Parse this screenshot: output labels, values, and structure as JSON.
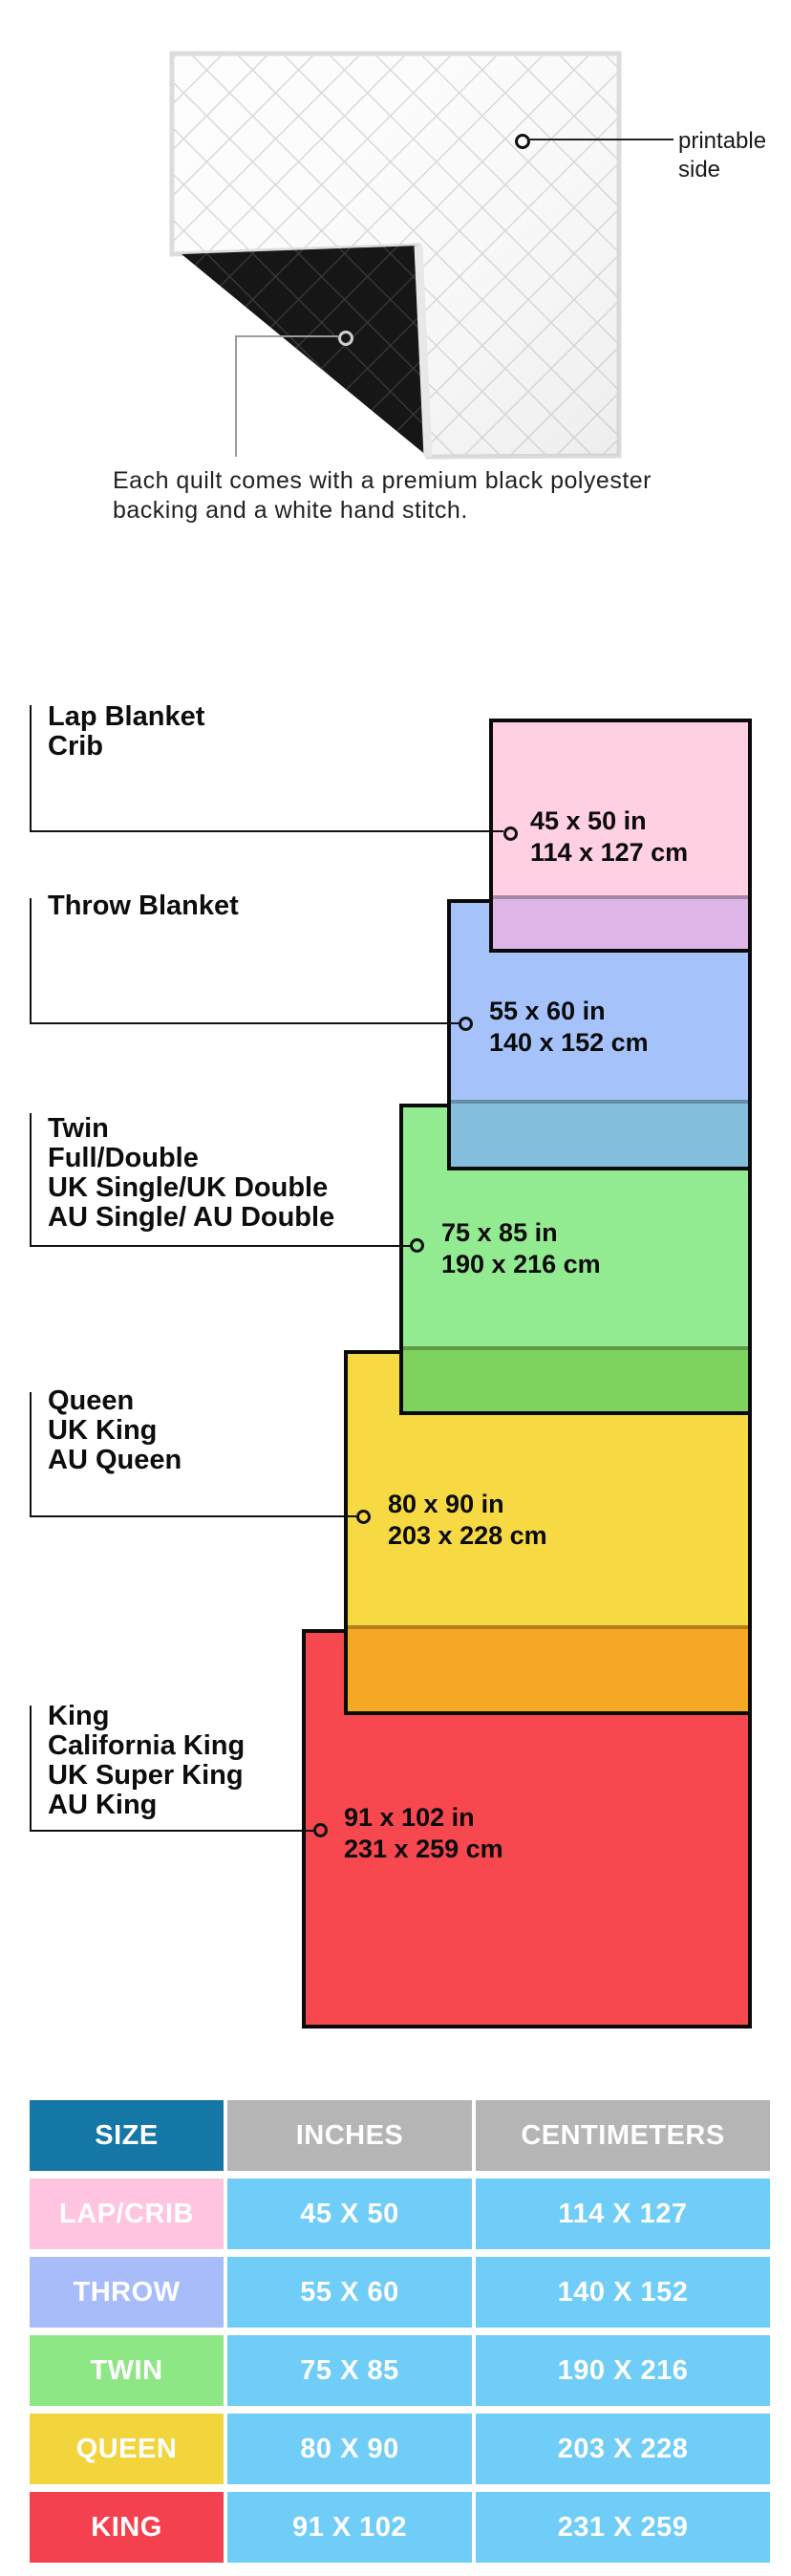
{
  "quilt": {
    "printable_label_line1": "printable",
    "printable_label_line2": "side",
    "caption_line1": "Each quilt comes with a premium black polyester",
    "caption_line2": "backing and a white hand stitch.",
    "front_color": "#fdfdfd",
    "back_color": "#151515"
  },
  "diagram": {
    "border_color": "#0a0a0a",
    "items": [
      {
        "id": "lap",
        "label_lines": [
          "Lap Blanket",
          "Crib"
        ],
        "size_in": "45 x 50 in",
        "size_cm": "114 x 127 cm",
        "fill": "#FFCFE4",
        "overlap_fill": "#DDB5E6"
      },
      {
        "id": "throw",
        "label_lines": [
          "Throw Blanket"
        ],
        "size_in": "55 x 60 in",
        "size_cm": "140 x 152 cm",
        "fill": "#A5C3FA",
        "overlap_fill": "#85BEDC"
      },
      {
        "id": "twin",
        "label_lines": [
          "Twin",
          "Full/Double",
          "UK Single/UK Double",
          "AU Single/ AU Double"
        ],
        "size_in": "75 x 85 in",
        "size_cm": "190 x 216 cm",
        "fill": "#92EB90",
        "overlap_fill": "#7ED35F"
      },
      {
        "id": "queen",
        "label_lines": [
          "Queen",
          "UK King",
          "AU Queen"
        ],
        "size_in": "80 x 90 in",
        "size_cm": "203 x 228 cm",
        "fill": "#F6D943",
        "overlap_fill": "#F5A824"
      },
      {
        "id": "king",
        "label_lines": [
          "King",
          "California King",
          "UK Super King",
          "AU King"
        ],
        "size_in": "91 x 102 in",
        "size_cm": "231 x 259 cm",
        "fill": "#F7474F",
        "overlap_fill": ""
      }
    ]
  },
  "table": {
    "headers": [
      "SIZE",
      "INCHES",
      "CENTIMETERS"
    ],
    "header_size_bg": "#1577A5",
    "header_gray_bg": "#B5B5B5",
    "data_cell_bg": "#6FCDF7",
    "rows": [
      {
        "label": "LAP/CRIB",
        "label_bg": "#FFC4DF",
        "inches": "45 X 50",
        "centimeters": "114 X 127"
      },
      {
        "label": "THROW",
        "label_bg": "#A9BCFA",
        "inches": "55 X 60",
        "centimeters": "140 X 152"
      },
      {
        "label": "TWIN",
        "label_bg": "#8DE785",
        "inches": "75 X 85",
        "centimeters": "190 X 216"
      },
      {
        "label": "QUEEN",
        "label_bg": "#F2D43C",
        "inches": "80 X 90",
        "centimeters": "203 X 228"
      },
      {
        "label": "KING",
        "label_bg": "#F4414F",
        "inches": "91 X 102",
        "centimeters": "231 X 259"
      }
    ]
  }
}
